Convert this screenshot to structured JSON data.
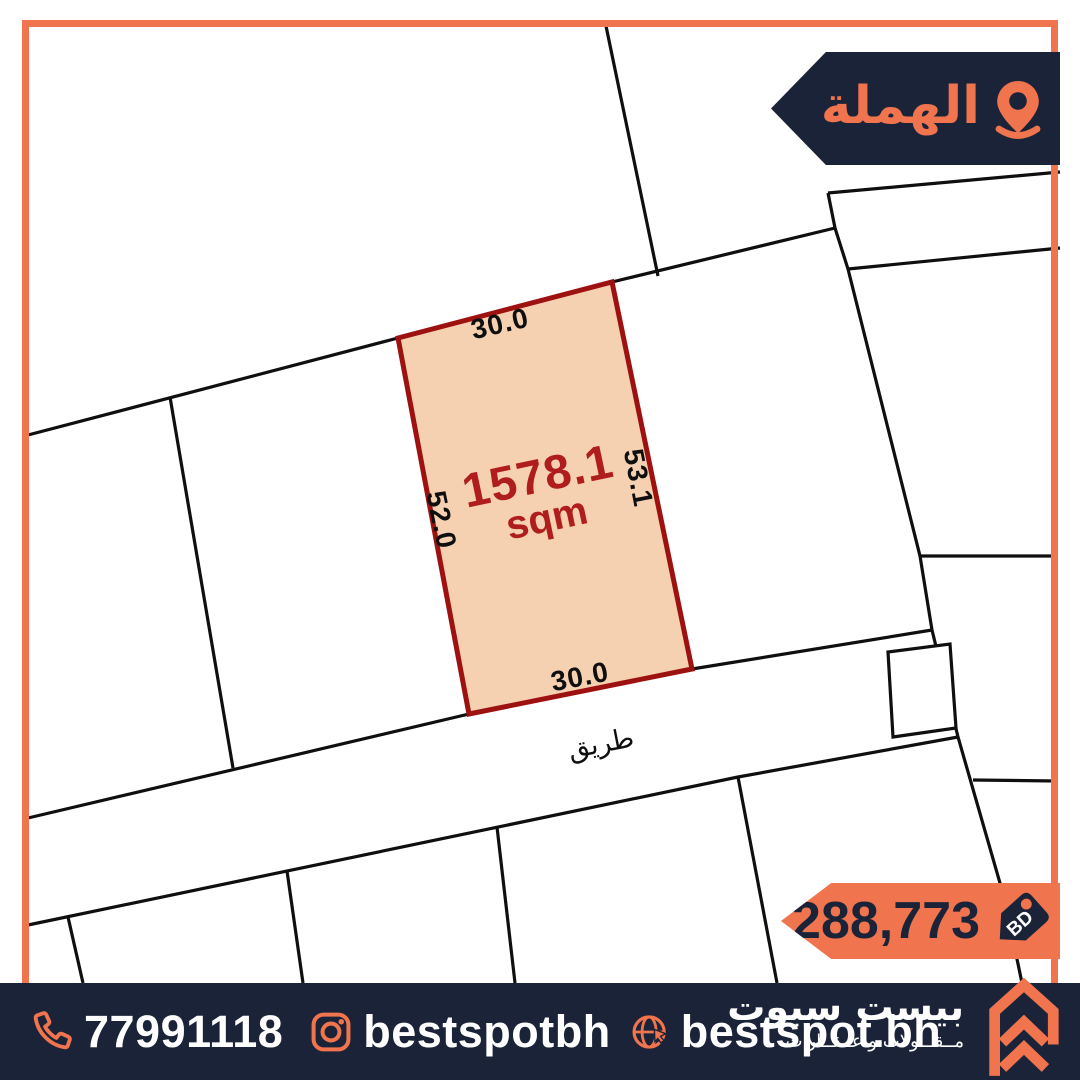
{
  "location_badge": {
    "label": "الهملة"
  },
  "map": {
    "plot": {
      "area_value": "1578.1",
      "area_unit": "sqm",
      "side_top": "30.0",
      "side_right": "53.1",
      "side_bottom": "30.0",
      "side_left": "52.0"
    },
    "road_label": "طريق"
  },
  "price_badge": {
    "amount": "288,773",
    "currency": "BD"
  },
  "footer": {
    "phone": "77991118",
    "instagram": "bestspotbh",
    "website": "bestspot.bh",
    "brand_name": "بيست سبوت",
    "brand_tagline": "مــقــاولات و عــقــارات"
  },
  "colors": {
    "orange": "#F0744D",
    "navy": "#1A2337",
    "plot_fill": "#F6D1B1",
    "plot_border": "#9E1111",
    "area_text": "#B01D1D"
  }
}
